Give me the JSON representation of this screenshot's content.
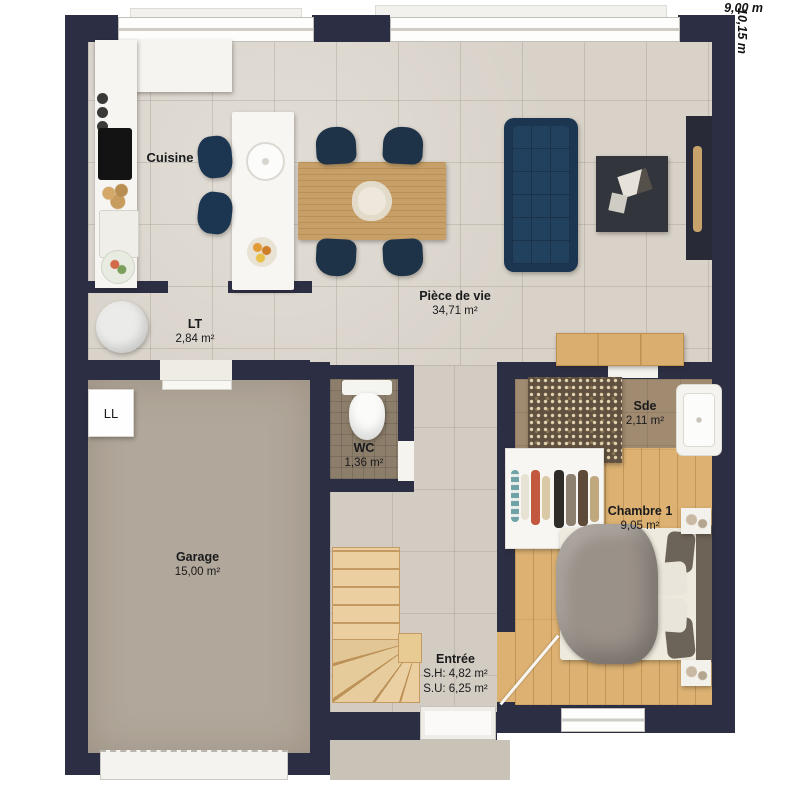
{
  "plan": {
    "dim_width": "9,00 m",
    "dim_height": "10,15 m",
    "rooms": {
      "cuisine": {
        "name": "Cuisine"
      },
      "piece_de_vie": {
        "name": "Pièce de vie",
        "area": "34,71 m²"
      },
      "lt": {
        "name": "LT",
        "area": "2,84 m²"
      },
      "garage": {
        "name": "Garage",
        "area": "15,00 m²"
      },
      "wc": {
        "name": "WC",
        "area": "1,36 m²"
      },
      "sde": {
        "name": "Sde",
        "area": "2,11 m²"
      },
      "chambre1": {
        "name": "Chambre 1",
        "area": "9,05 m²"
      },
      "entree": {
        "name": "Entrée",
        "sh": "S.H: 4,82 m²",
        "su": "S.U: 6,25 m²"
      }
    },
    "appliances": {
      "washing_machine": "LL"
    },
    "colors": {
      "wall": "#2c2e44",
      "tile_floor": "#d8d2c9",
      "wood_floor": "#dcb172",
      "garage_floor": "#b1a79a",
      "sofa": "#1c3550",
      "accent_wood": "#d9ae6e"
    }
  }
}
